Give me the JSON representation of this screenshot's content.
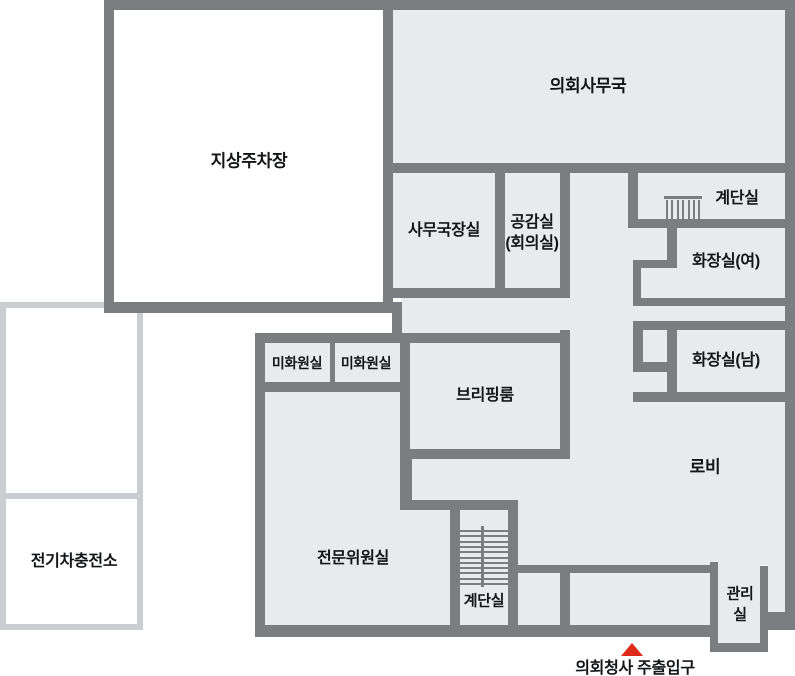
{
  "palette": {
    "wall": "#7b7e81",
    "room_fill": "#e8ebed",
    "white_fill": "#ffffff",
    "ev_stroke": "#cbced1",
    "text": "#141517",
    "entrance_red": "#de2a1d"
  },
  "canvas": {
    "width": 795,
    "height": 676
  },
  "ev_station": {
    "rects": [
      [
        0,
        302,
        143,
        197
      ],
      [
        0,
        493,
        143,
        137
      ]
    ],
    "stroke_width": 6
  },
  "rooms": [
    {
      "id": "ground-parking",
      "rect": [
        114,
        10,
        269,
        292
      ],
      "fill": "white"
    },
    {
      "id": "council-secretariat",
      "rect": [
        393,
        10,
        392,
        153
      ]
    },
    {
      "id": "secretary-general-office",
      "rect": [
        393,
        173,
        102,
        117
      ]
    },
    {
      "id": "gonggam-meeting-room",
      "rect": [
        505,
        173,
        55,
        117
      ]
    },
    {
      "id": "stairwell-top",
      "rect": [
        638,
        173,
        147,
        46
      ]
    },
    {
      "id": "restroom-women",
      "rect": [
        677,
        228,
        108,
        70
      ]
    },
    {
      "id": "restroom-men",
      "rect": [
        677,
        330,
        108,
        62
      ]
    },
    {
      "id": "janitor-room-1",
      "rect": [
        265,
        343,
        65,
        39
      ]
    },
    {
      "id": "janitor-room-2",
      "rect": [
        335,
        343,
        65,
        39
      ]
    },
    {
      "id": "briefing-room",
      "rect": [
        410,
        343,
        150,
        106
      ]
    },
    {
      "id": "expert-committee-room",
      "rect": [
        265,
        392,
        185,
        233
      ]
    },
    {
      "id": "stairwell-bottom",
      "rect": [
        460,
        510,
        48,
        115
      ]
    },
    {
      "id": "management-room",
      "rect": [
        718,
        565,
        42,
        78
      ]
    },
    {
      "id": "lobby",
      "rect": [
        570,
        402,
        215,
        163
      ]
    }
  ],
  "areas": [
    {
      "id": "corridor-upper",
      "rect": [
        570,
        173,
        63,
        229
      ]
    },
    {
      "id": "open-strip-offices",
      "rect": [
        402,
        298,
        231,
        35
      ]
    },
    {
      "id": "restroom-w-entry",
      "rect": [
        633,
        228,
        34,
        32
      ]
    },
    {
      "id": "restroom-w-niche",
      "rect": [
        641,
        268,
        36,
        30
      ]
    },
    {
      "id": "restroom-corridor",
      "rect": [
        633,
        306,
        152,
        15
      ]
    },
    {
      "id": "restroom-m-niche",
      "rect": [
        643,
        330,
        24,
        32
      ]
    },
    {
      "id": "restroom-m-entry",
      "rect": [
        633,
        372,
        34,
        20
      ]
    },
    {
      "id": "lobby-band-west",
      "rect": [
        412,
        459,
        158,
        41
      ]
    },
    {
      "id": "lobby-band-stair",
      "rect": [
        518,
        500,
        52,
        65
      ]
    },
    {
      "id": "vestibule-west",
      "rect": [
        518,
        573,
        42,
        52
      ]
    },
    {
      "id": "vestibule-entrance",
      "rect": [
        570,
        573,
        140,
        52
      ]
    },
    {
      "id": "lobby-strip-east",
      "rect": [
        768,
        565,
        17,
        47
      ]
    }
  ],
  "walls": [
    [
      104,
      0,
      691,
      10
    ],
    [
      104,
      0,
      10,
      313
    ],
    [
      104,
      302,
      289,
      11
    ],
    [
      383,
      0,
      10,
      313
    ],
    [
      392,
      302,
      10,
      41
    ],
    [
      785,
      0,
      10,
      618
    ],
    [
      255,
      333,
      10,
      304
    ],
    [
      255,
      333,
      315,
      10
    ],
    [
      255,
      625,
      457,
      12
    ],
    [
      762,
      612,
      33,
      18
    ],
    [
      710,
      562,
      8,
      90
    ],
    [
      710,
      643,
      58,
      9
    ],
    [
      760,
      566,
      8,
      86
    ],
    [
      508,
      565,
      202,
      8
    ],
    [
      560,
      573,
      10,
      52
    ],
    [
      383,
      163,
      412,
      10
    ],
    [
      495,
      173,
      10,
      125
    ],
    [
      383,
      288,
      187,
      10
    ],
    [
      560,
      163,
      10,
      132
    ],
    [
      560,
      330,
      10,
      129
    ],
    [
      628,
      163,
      10,
      65
    ],
    [
      628,
      219,
      167,
      9
    ],
    [
      667,
      228,
      10,
      40
    ],
    [
      633,
      260,
      35,
      8
    ],
    [
      633,
      260,
      8,
      38
    ],
    [
      633,
      298,
      162,
      8
    ],
    [
      633,
      321,
      162,
      9
    ],
    [
      633,
      330,
      10,
      33
    ],
    [
      633,
      362,
      37,
      10
    ],
    [
      667,
      330,
      10,
      62
    ],
    [
      633,
      392,
      162,
      10
    ],
    [
      330,
      343,
      5,
      39
    ],
    [
      255,
      382,
      155,
      10
    ],
    [
      400,
      449,
      170,
      10
    ],
    [
      400,
      459,
      12,
      51
    ],
    [
      400,
      500,
      118,
      10
    ],
    [
      450,
      505,
      10,
      120
    ],
    [
      508,
      505,
      10,
      120
    ],
    [
      400,
      333,
      10,
      126
    ]
  ],
  "stairs_top": {
    "rail": [
      664,
      196,
      38,
      3
    ],
    "bars": {
      "x0": 666,
      "y": 200,
      "height": 19,
      "count": 7,
      "gap": 5.4,
      "width": 2
    }
  },
  "stairs_bottom": {
    "divider": [
      481,
      526,
      3,
      61
    ],
    "lines": {
      "x": 460,
      "y0": 530,
      "width": 48,
      "count": 11,
      "gap": 5.3,
      "thickness": 2
    }
  },
  "labels": [
    {
      "id": "ground-parking",
      "text": "지상주차장",
      "x": 249,
      "y": 161,
      "fs": 17
    },
    {
      "id": "council-secretariat",
      "text": "의회사무국",
      "x": 588,
      "y": 86,
      "fs": 17
    },
    {
      "id": "secretary-general-office",
      "text": "사무국장실",
      "x": 444,
      "y": 231,
      "fs": 16
    },
    {
      "id": "gonggam-line1",
      "text": "공감실",
      "x": 532,
      "y": 223,
      "fs": 16
    },
    {
      "id": "gonggam-line2",
      "text": "(회의실)",
      "x": 532,
      "y": 244,
      "fs": 16
    },
    {
      "id": "stairwell-top",
      "text": "계단실",
      "x": 737,
      "y": 199,
      "fs": 16
    },
    {
      "id": "restroom-women",
      "text": "화장실(여)",
      "x": 726,
      "y": 262,
      "fs": 16
    },
    {
      "id": "restroom-men",
      "text": "화장실(남)",
      "x": 726,
      "y": 361,
      "fs": 16
    },
    {
      "id": "janitor-room-1",
      "text": "미화원실",
      "x": 297,
      "y": 363,
      "fs": 14
    },
    {
      "id": "janitor-room-2",
      "text": "미화원실",
      "x": 366,
      "y": 363,
      "fs": 14
    },
    {
      "id": "briefing-room",
      "text": "브리핑룸",
      "x": 485,
      "y": 396,
      "fs": 16
    },
    {
      "id": "lobby",
      "text": "로비",
      "x": 705,
      "y": 467,
      "fs": 17
    },
    {
      "id": "expert-committee-room",
      "text": "전문위원실",
      "x": 353,
      "y": 559,
      "fs": 16
    },
    {
      "id": "stairwell-bottom",
      "text": "계단실",
      "x": 484,
      "y": 601,
      "fs": 15
    },
    {
      "id": "management-line1",
      "text": "관리",
      "x": 740,
      "y": 594,
      "fs": 15
    },
    {
      "id": "management-line2",
      "text": "실",
      "x": 740,
      "y": 615,
      "fs": 15
    },
    {
      "id": "ev-charging-station",
      "text": "전기차충전소",
      "x": 74,
      "y": 562,
      "fs": 16
    }
  ],
  "entrance": {
    "label": "의회청사 주출입구",
    "label_x": 635,
    "label_y": 666,
    "fs": 16,
    "marker_x": 632,
    "marker_y": 643
  }
}
